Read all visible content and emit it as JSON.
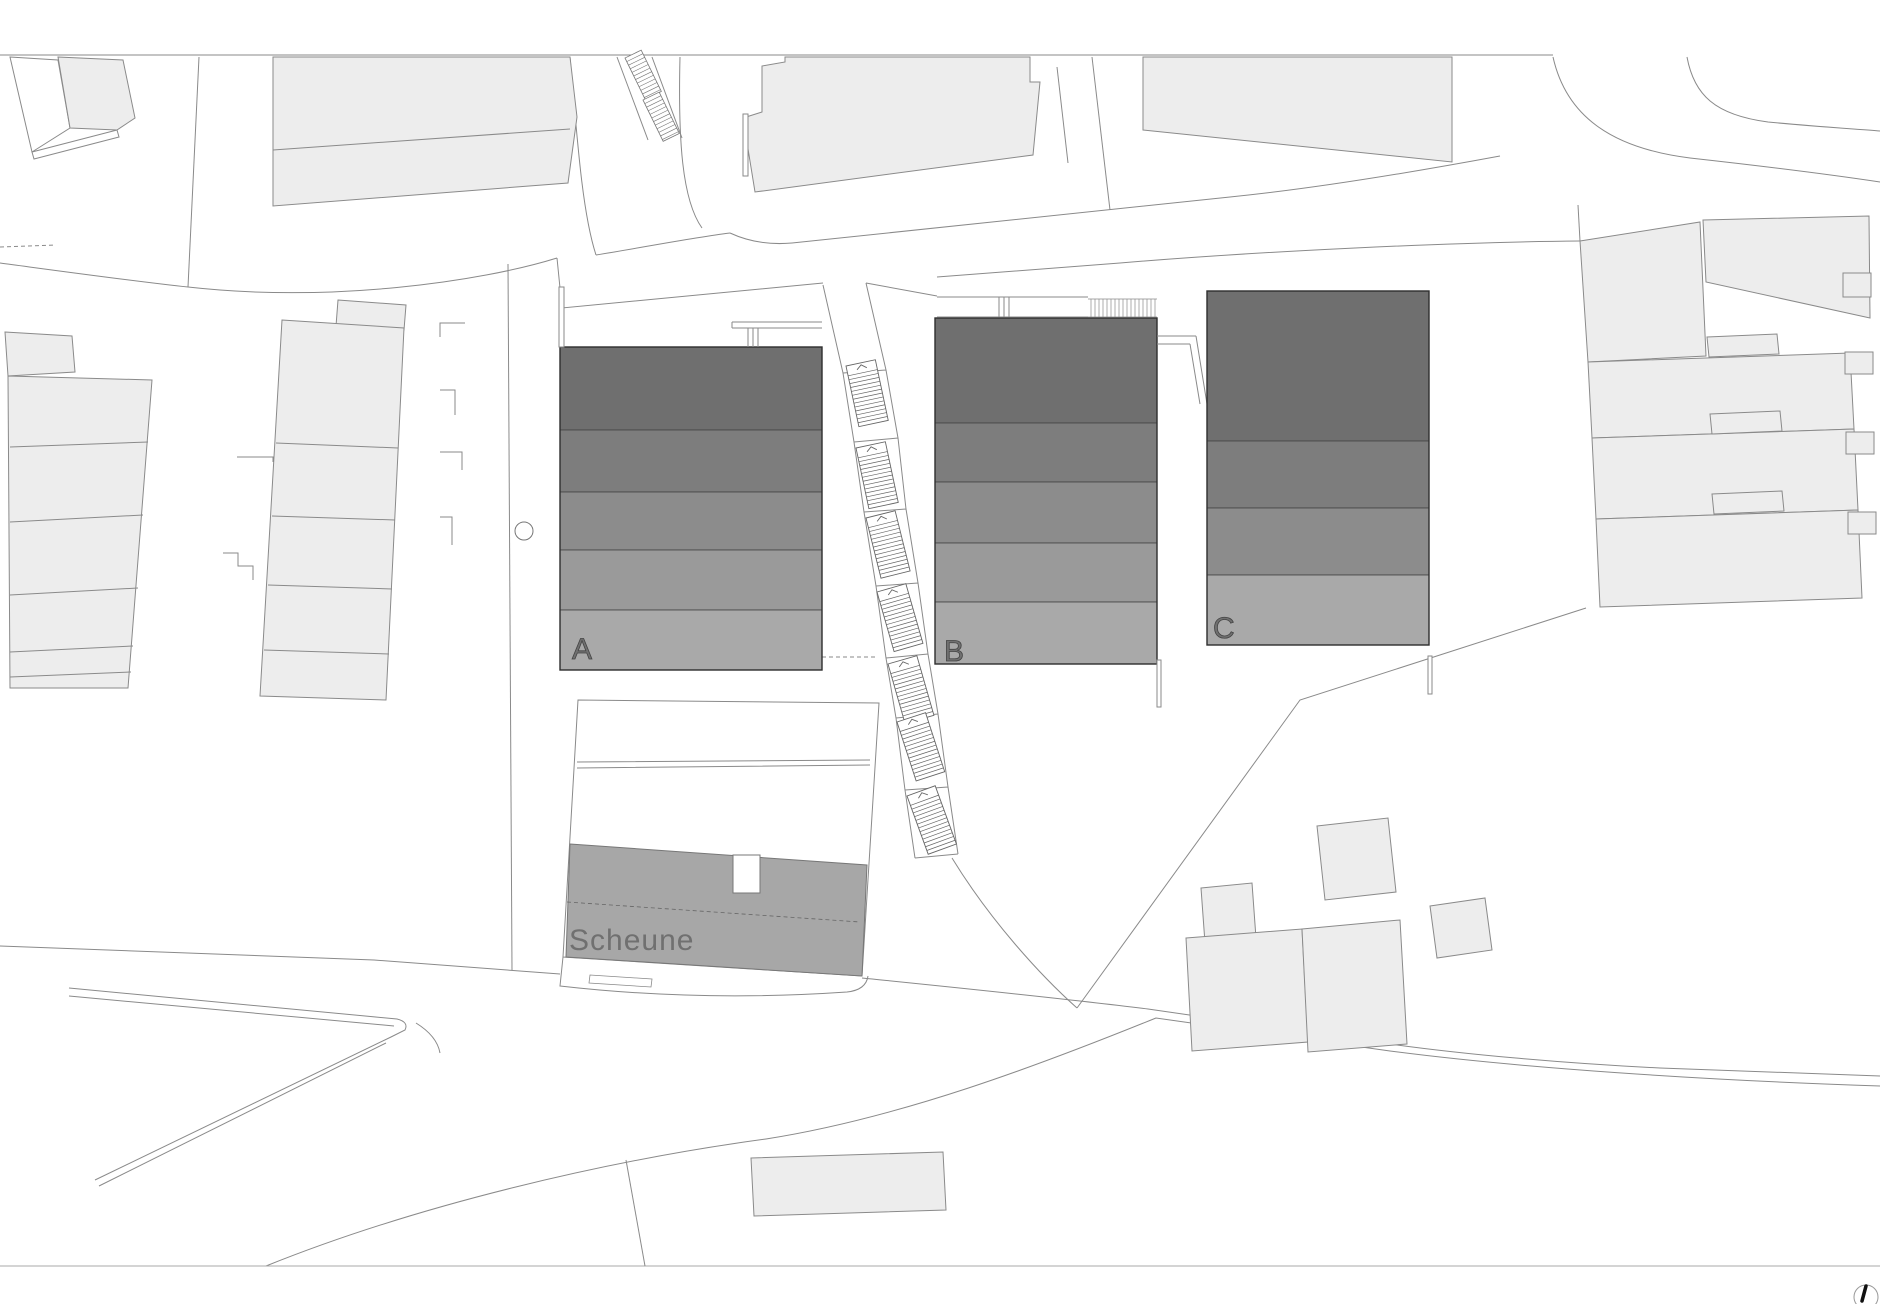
{
  "title": "Site plan (Lageplan)",
  "labels": {
    "building_a": "A",
    "building_b": "B",
    "building_c": "C",
    "barn": "Scheune"
  },
  "colors": {
    "background": "#ffffff",
    "floor1": "#6f6f6f",
    "floor2": "#7d7d7d",
    "floor3": "#8c8c8c",
    "floor4": "#9a9a9a",
    "floor5": "#a9a9a9",
    "barn_fill": "#a7a7a7",
    "context_fill": "#ededed",
    "context_line": "#8a8a8a",
    "main_line": "#3a3a3a",
    "label_text": "#707070",
    "north_needle": "#111111"
  },
  "icons": {
    "north_arrow": "north-arrow"
  }
}
